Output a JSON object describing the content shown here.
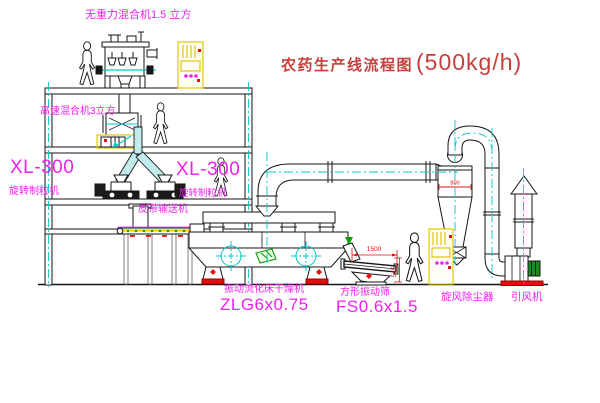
{
  "title": {
    "name_cn": "农药生产线流程图",
    "capacity": "(500kg/h)"
  },
  "equipment_labels": {
    "gravity_mixer": "无重力混合机1.5 立方",
    "high_speed_mixer": "高速混合机3立方",
    "granulator_left_model": "XL-300",
    "granulator_left_name": "旋转制粒机",
    "granulator_center_model": "XL-300",
    "granulator_center_name": "旋转制粒机",
    "belt_conveyor": "皮带输送机",
    "fluid_bed_dryer_name": "振动流化床干燥机",
    "fluid_bed_dryer_model": "ZLG6x0.75",
    "vibrating_screen_name": "方形振动筛",
    "vibrating_screen_model": "FS0.6x1.5",
    "cyclone": "旋风除尘器",
    "induced_draft_fan": "引风机"
  },
  "dimensions": {
    "screen_length": "1500",
    "screen_height": "545",
    "cyclone_dia": "800"
  },
  "colors": {
    "outline": "#161616",
    "centerline_cyan": "#00c8c8",
    "label_magenta": "#f020f0",
    "title_red": "#c5403c",
    "accent_red": "#e01010",
    "panel_yellow": "#e0c800",
    "motor_green": "#1d8a1d"
  }
}
